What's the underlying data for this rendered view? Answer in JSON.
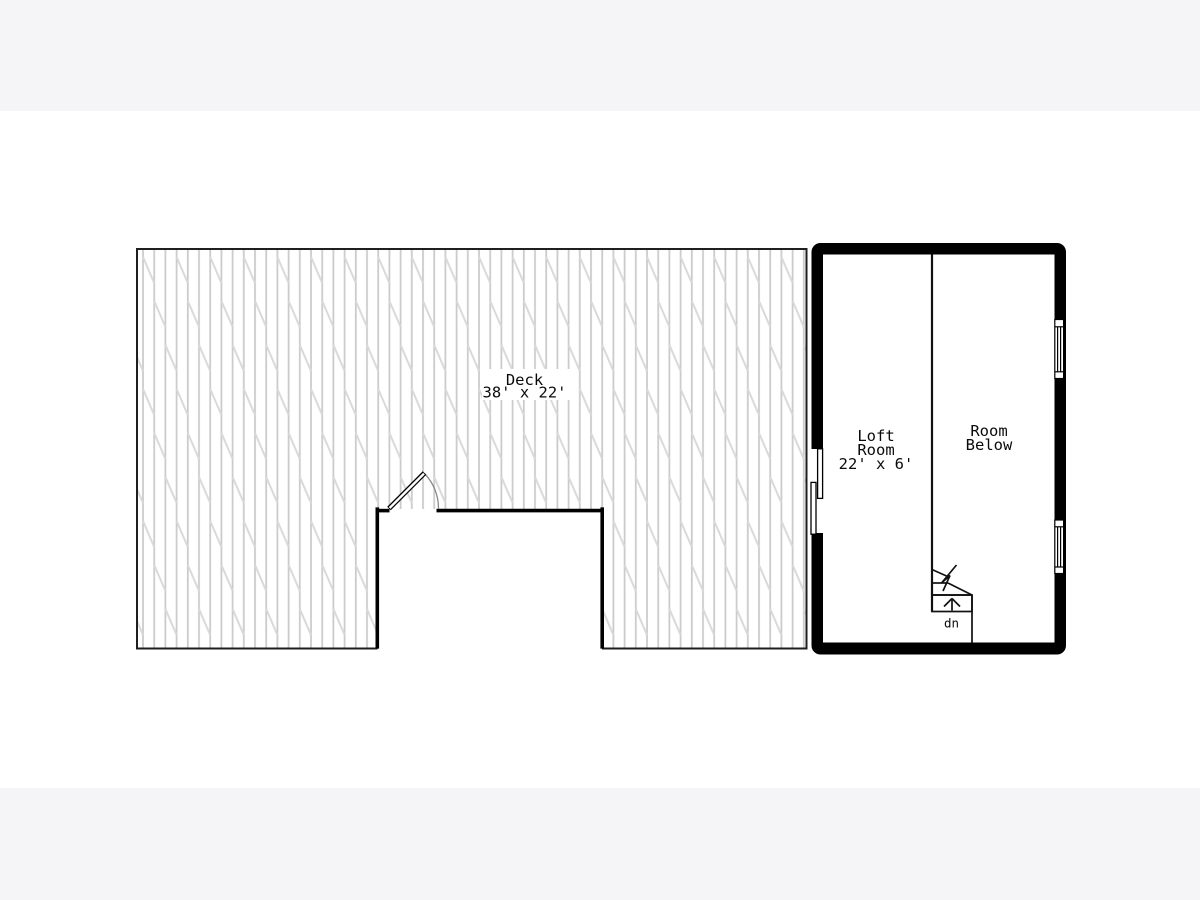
{
  "view": {
    "letterbox_color": "#f5f4f6",
    "canvas_color": "#ffffff"
  },
  "floor_plan": {
    "deck": {
      "name_label": "Deck",
      "dimensions_label": "38' x 22'"
    },
    "loft_room": {
      "name_line1": "Loft",
      "name_line2": "Room",
      "dimensions_label": "22' x 6'"
    },
    "room_below": {
      "name_line1": "Room",
      "name_line2": "Below"
    },
    "staircase": {
      "direction_label": "dn"
    },
    "colors": {
      "wall": "#000000",
      "outline": "#1f1f1f",
      "plank_line": "#cbcbcb",
      "plank_joint": "#d9d9d9",
      "detail_line": "#111111",
      "door_arc": "#8a8a8a",
      "text": "#0a0a0a"
    }
  }
}
